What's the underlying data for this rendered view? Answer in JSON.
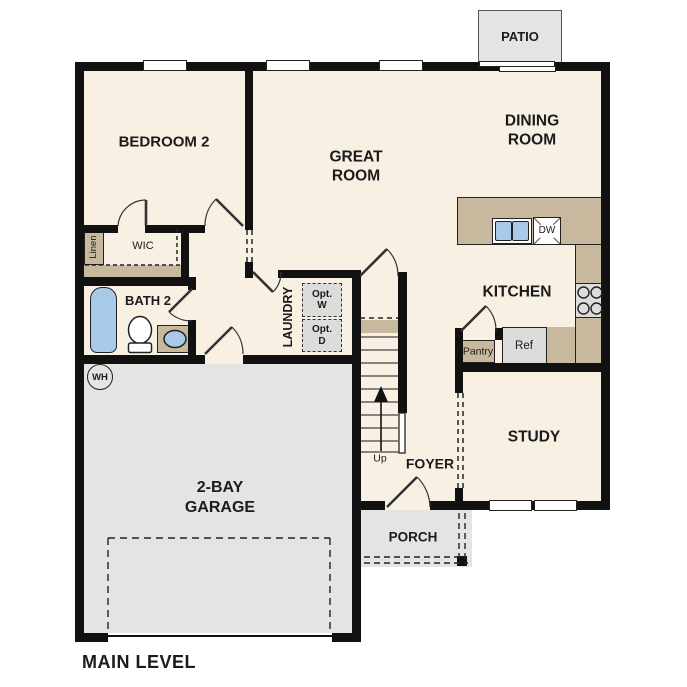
{
  "title": "MAIN LEVEL",
  "plan": {
    "rooms": {
      "patio": {
        "label": "PATIO"
      },
      "bedroom2": {
        "label": "BEDROOM 2"
      },
      "great_room": {
        "label": "GREAT ROOM"
      },
      "dining_room": {
        "label": "DINING ROOM"
      },
      "kitchen": {
        "label": "KITCHEN"
      },
      "study": {
        "label": "STUDY"
      },
      "foyer": {
        "label": "FOYER"
      },
      "porch": {
        "label": "PORCH"
      },
      "garage": {
        "label": "2-BAY GARAGE"
      },
      "laundry": {
        "label": "LAUNDRY"
      },
      "bath2": {
        "label": "BATH 2"
      }
    },
    "closets": {
      "wic": {
        "label": "WIC"
      },
      "linen": {
        "label": "Linen"
      },
      "pantry": {
        "label": "Pantry"
      }
    },
    "fixtures": {
      "refrigerator": {
        "label": "Ref"
      },
      "dishwasher": {
        "label": "DW"
      },
      "optional_washer": {
        "label": "Opt. W"
      },
      "optional_dryer": {
        "label": "Opt. D"
      },
      "water_heater": {
        "label": "WH"
      },
      "stairs": {
        "label": "Up"
      }
    },
    "colors": {
      "wall": "#111111",
      "floor": "#f7f0e3",
      "counter_tan": "#c7b89e",
      "exterior_gray": "#e4e4e2",
      "appliance_gray": "#dcdcda",
      "fixture_blue": "#a9c9e9"
    }
  }
}
